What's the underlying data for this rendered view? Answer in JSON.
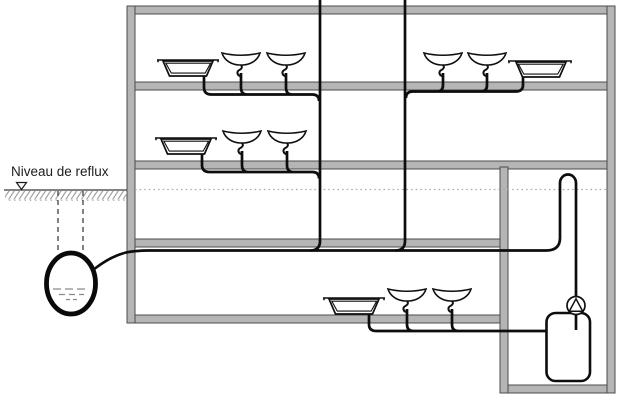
{
  "labels": {
    "reflux_level": "Niveau de reflux"
  },
  "colors": {
    "background": "#ffffff",
    "wall_fill": "#b5b5b5",
    "wall_border": "#4c4c4c",
    "pipe": "#0d0d0d",
    "ground_line": "#5a5a5a",
    "hatch": "#9a9a9a",
    "reflux_dotted_line": "#ababab",
    "water_dashes": "#8a8a8a",
    "label_text": "#1c1c1c"
  },
  "diagram": {
    "type": "plumbing-backflow-schematic",
    "marker": "open-triangle-level-marker",
    "floors": [
      {
        "name": "top-floor",
        "fixtures": [
          "bathtub",
          "washbasin",
          "washbasin",
          "washbasin",
          "washbasin",
          "bathtub"
        ],
        "drains_to": [
          "vent-stack-1",
          "vent-stack-2"
        ]
      },
      {
        "name": "middle-floor",
        "fixtures": [
          "bathtub",
          "washbasin",
          "washbasin"
        ],
        "drains_to": [
          "vent-stack-1"
        ]
      },
      {
        "name": "basement",
        "fixtures": [
          "bathtub",
          "washbasin",
          "washbasin"
        ],
        "drains_to": [
          "lifting-tank"
        ]
      }
    ],
    "components": [
      "vent-stack-1",
      "vent-stack-2",
      "gravity-collector",
      "outdoor-sump",
      "anti-backflow-loop",
      "pump",
      "lifting-tank"
    ]
  }
}
